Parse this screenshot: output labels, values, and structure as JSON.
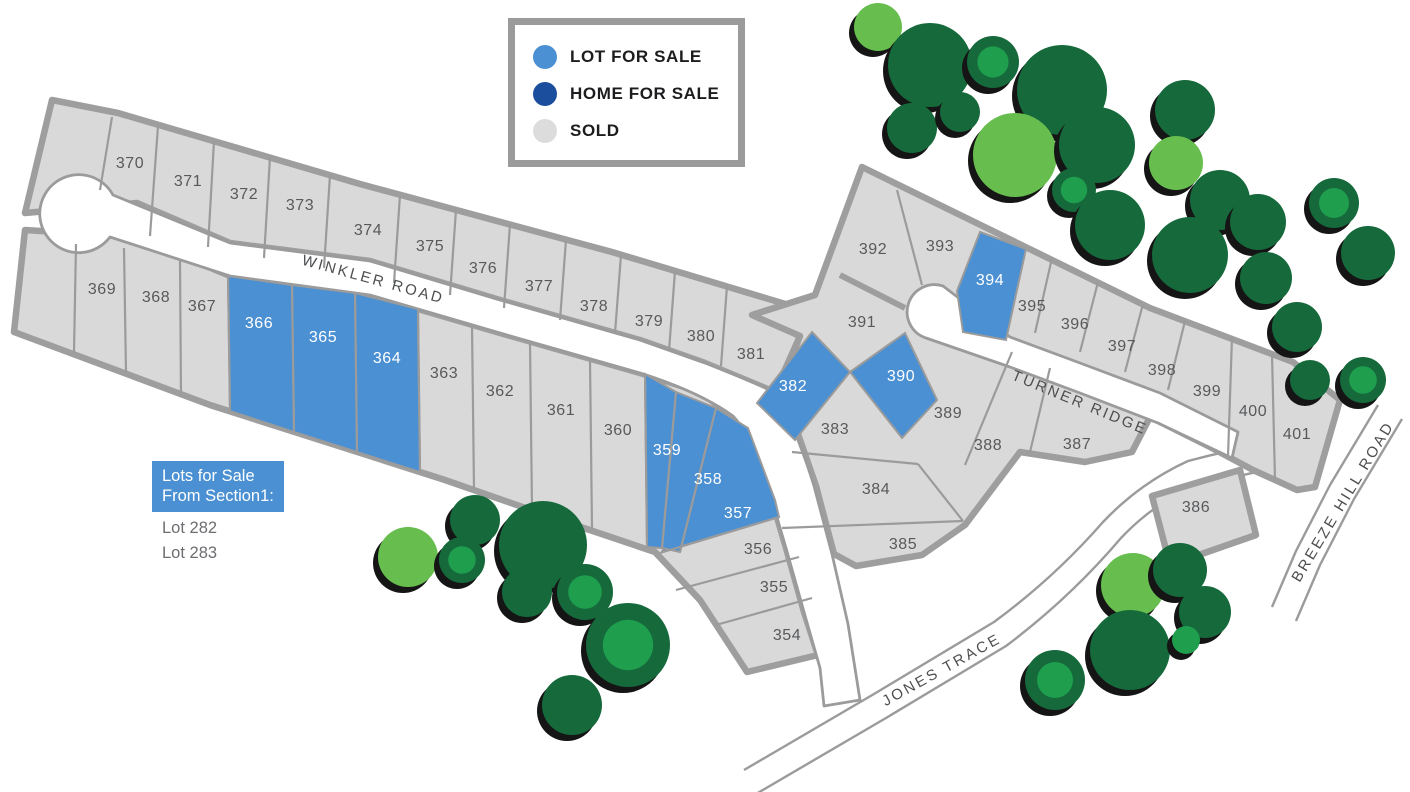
{
  "title": "Subdivision lot availability map",
  "legend": {
    "items": [
      {
        "label": "LOT FOR SALE",
        "color": "#4a90d2"
      },
      {
        "label": "HOME FOR SALE",
        "color": "#1b4f9e"
      },
      {
        "label": "SOLD",
        "color": "#dcdcdc"
      }
    ]
  },
  "roads": {
    "winkler": "WINKLER ROAD",
    "turner": "TURNER RIDGE",
    "jones": "JONES TRACE",
    "breeze": "BREEZE HILL ROAD"
  },
  "note": {
    "title_line1": "Lots for Sale",
    "title_line2": "From Section1:",
    "items": [
      "Lot 282",
      "Lot 283"
    ]
  },
  "colors": {
    "lot_for_sale": "#4a90d2",
    "home_for_sale": "#1b4f9e",
    "sold_fill": "#d9d9d9",
    "block_border": "#9e9e9e",
    "lot_line": "#9b9b9b",
    "lot_number_text": "#58595b",
    "tree_dark": "#15693b",
    "tree_mid": "#1f9e4e",
    "tree_light": "#67be4e",
    "tree_shadow": "#151515"
  },
  "lots": [
    {
      "number": "354",
      "status": "sold"
    },
    {
      "number": "355",
      "status": "sold"
    },
    {
      "number": "356",
      "status": "sold"
    },
    {
      "number": "357",
      "status": "lot-for-sale"
    },
    {
      "number": "358",
      "status": "lot-for-sale"
    },
    {
      "number": "359",
      "status": "lot-for-sale"
    },
    {
      "number": "360",
      "status": "sold"
    },
    {
      "number": "361",
      "status": "sold"
    },
    {
      "number": "362",
      "status": "sold"
    },
    {
      "number": "363",
      "status": "sold"
    },
    {
      "number": "364",
      "status": "lot-for-sale"
    },
    {
      "number": "365",
      "status": "lot-for-sale"
    },
    {
      "number": "366",
      "status": "lot-for-sale"
    },
    {
      "number": "367",
      "status": "sold"
    },
    {
      "number": "368",
      "status": "sold"
    },
    {
      "number": "369",
      "status": "sold"
    },
    {
      "number": "370",
      "status": "sold"
    },
    {
      "number": "371",
      "status": "sold"
    },
    {
      "number": "372",
      "status": "sold"
    },
    {
      "number": "373",
      "status": "sold"
    },
    {
      "number": "374",
      "status": "sold"
    },
    {
      "number": "375",
      "status": "sold"
    },
    {
      "number": "376",
      "status": "sold"
    },
    {
      "number": "377",
      "status": "sold"
    },
    {
      "number": "378",
      "status": "sold"
    },
    {
      "number": "379",
      "status": "sold"
    },
    {
      "number": "380",
      "status": "sold"
    },
    {
      "number": "381",
      "status": "sold"
    },
    {
      "number": "382",
      "status": "lot-for-sale"
    },
    {
      "number": "383",
      "status": "sold"
    },
    {
      "number": "384",
      "status": "sold"
    },
    {
      "number": "385",
      "status": "sold"
    },
    {
      "number": "386",
      "status": "sold"
    },
    {
      "number": "387",
      "status": "sold"
    },
    {
      "number": "388",
      "status": "sold"
    },
    {
      "number": "389",
      "status": "sold"
    },
    {
      "number": "390",
      "status": "lot-for-sale"
    },
    {
      "number": "391",
      "status": "sold"
    },
    {
      "number": "392",
      "status": "sold"
    },
    {
      "number": "393",
      "status": "sold"
    },
    {
      "number": "394",
      "status": "lot-for-sale"
    },
    {
      "number": "395",
      "status": "sold"
    },
    {
      "number": "396",
      "status": "sold"
    },
    {
      "number": "397",
      "status": "sold"
    },
    {
      "number": "398",
      "status": "sold"
    },
    {
      "number": "399",
      "status": "sold"
    },
    {
      "number": "400",
      "status": "sold"
    },
    {
      "number": "401",
      "status": "sold"
    }
  ]
}
